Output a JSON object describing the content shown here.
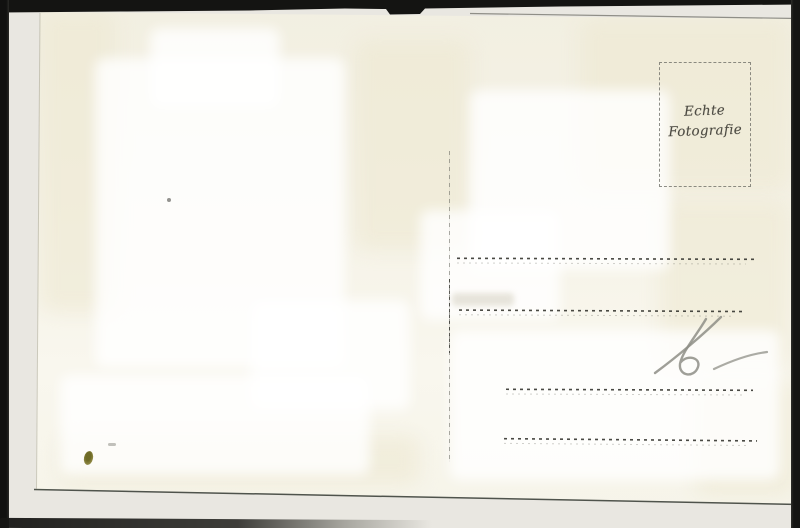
{
  "postcard": {
    "stamp_box": {
      "line1": "Echte",
      "line2": "Fotografie"
    },
    "handwriting": {
      "text": "16"
    }
  },
  "colors": {
    "frame": "#141412",
    "scan_background": "#e9e7e1",
    "card": "#f5f2e6",
    "ink": "#4e4c44",
    "pencil": "#8e8e86",
    "stain": "#6e6a26"
  }
}
